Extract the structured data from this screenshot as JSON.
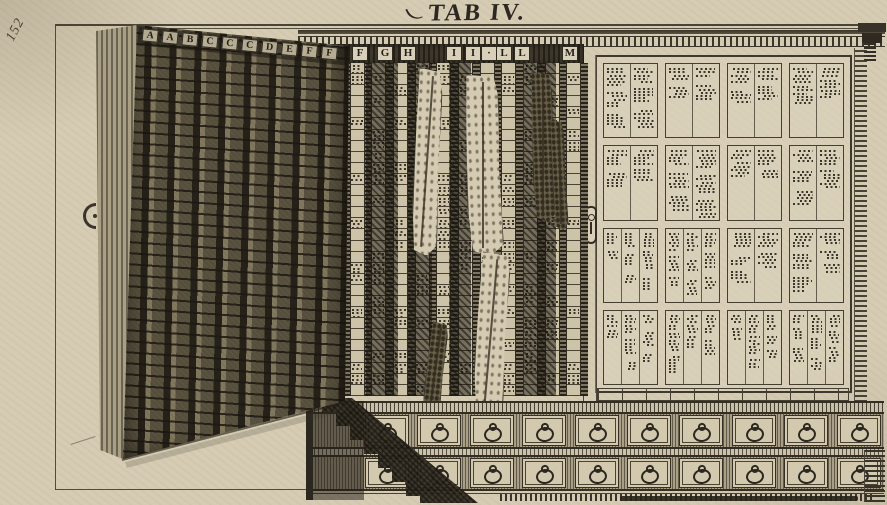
{
  "plate": {
    "title": "TAB IV.",
    "page_number": "152"
  },
  "cabinet": {
    "door_letters": [
      "A",
      "A",
      "B",
      "C",
      "C",
      "C",
      "D",
      "E",
      "F",
      "F"
    ],
    "shelf_letters": [
      "F",
      "F",
      "G",
      "H",
      "I",
      "I",
      "·",
      "L",
      "L",
      "M"
    ],
    "middle_columns": {
      "count": 12,
      "cell_rows": 30
    },
    "right_label_panel": {
      "rows": 4,
      "cols": 4
    },
    "drawer_unit": {
      "rows": 2,
      "drawers_per_row": 10
    },
    "specimen_count": 6,
    "hardware": {
      "drawer_pull_icon": "ring-pull",
      "lock_icon": "keyhole-escutcheon",
      "hinge_icon": "hinge-knuckle"
    }
  },
  "colors": {
    "paper": "#d6ccb4",
    "ink": "#332e24",
    "ink_dark": "#211d16",
    "door_wood": "#6e6550",
    "shadow": "#2e2a20",
    "label_paper": "#d9d0ba"
  }
}
